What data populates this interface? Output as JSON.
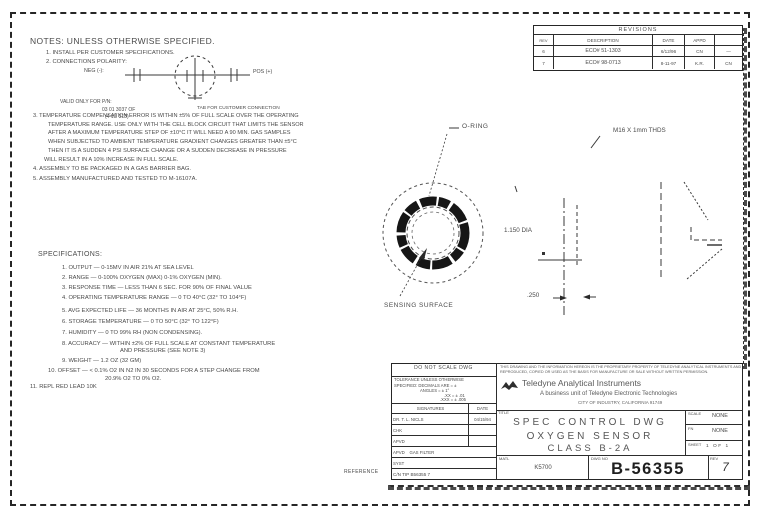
{
  "notes": {
    "heading": "NOTES: UNLESS OTHERWISE SPECIFIED.",
    "note1": "1. INSTALL PER CUSTOMER SPECIFICATIONS.",
    "note2": "2. CONNECTIONS POLARITY:",
    "polarity_neg": "NEG (-):",
    "polarity_pos": "POS (+)",
    "polarity_tab": "TAB FOR CUSTOMER CONNECTION",
    "valid1": "VALID ONLY FOR P/N:",
    "valid2": "03 01 3037 OF",
    "valid3": "(4 1U 313)",
    "note3_l1": "3. TEMPERATURE COMPENSATION ERROR IS WITHIN ±5% OF FULL SCALE OVER THE OPERATING",
    "note3_l2": "TEMPERATURE RANGE. USE ONLY WITH THE CELL BLOCK CIRCUIT THAT LIMITS THE SENSOR",
    "note3_l3": "AFTER A MAXIMUM TEMPERATURE STEP OF ±10°C IT WILL NEED A 90 MIN. GAS SAMPLES",
    "note3_l4": "WHEN SUBJECTED TO AMBIENT TEMPERATURE GRADIENT CHANGES GREATER THAN ±5°C",
    "note3_l5": "THEN IT IS A SUDDEN 4 PSI SURFACE CHANGE OR A SUDDEN DECREASE IN PRESSURE",
    "note3_l6": "WILL RESULT IN A 10% INCREASE IN FULL SCALE.",
    "note4": "4. ASSEMBLY TO BE PACKAGED IN A GAS BARRIER BAG.",
    "note5": "5. ASSEMBLY MANUFACTURED AND TESTED TO M-16107A."
  },
  "specs": {
    "heading": "SPECIFICATIONS:",
    "s1": "1. OUTPUT — 0-15MV IN AIR 21% AT SEA LEVEL",
    "s2": "2. RANGE — 0-100% OXYGEN (MAX) 0-1% OXYGEN (MIN).",
    "s3": "3. RESPONSE TIME — LESS THAN 6 SEC. FOR 90% OF FINAL VALUE",
    "s4": "4. OPERATING TEMPERATURE RANGE — 0 TO 40°C (32° TO 104°F)",
    "s5": "5. AVG EXPECTED LIFE — 36 MONTHS IN AIR AT 25°C, 50% R.H.",
    "s6": "6. STORAGE TEMPERATURE — 0 TO 50°C (32° TO 122°F)",
    "s7": "7. HUMIDITY — 0 TO 99% RH (NON CONDENSING).",
    "s8a": "8. ACCURACY — WITHIN ±2% OF FULL SCALE AT CONSTANT TEMPERATURE",
    "s8b": "AND PRESSURE (SEE NOTE 3)",
    "s9": "9. WEIGHT — 1.2 OZ (32 GM)",
    "s10a": "10. OFFSET — < 0.1% O2 IN N2 IN 30 SECONDS FOR A STEP CHANGE FROM",
    "s10b": "20.9% O2 TO 0% O2.",
    "s11": "11. REPL RED LEAD 10K"
  },
  "views": {
    "oring": "O-RING",
    "sensing": "SENSING SURFACE",
    "dia": "1.150 DIA",
    "thk": ".250",
    "thread": "M16 X 1mm THDS"
  },
  "revisions": {
    "title": "REVISIONS",
    "h_rev": "REV",
    "h_desc": "DESCRIPTION",
    "h_date": "DATE",
    "h_appd": "APPD",
    "h_chk": "",
    "rows": [
      {
        "rev": "6",
        "desc": "ECO# 51-1303",
        "date": "6/12/96",
        "appd": "CN",
        "chk": "—"
      },
      {
        "rev": "7",
        "desc": "ECO# 98-0713",
        "date": "8-11-97",
        "appd": "K.R.",
        "chk": "CN"
      }
    ]
  },
  "title_block": {
    "do_not_scale": "DO NOT SCALE DWG",
    "tol1": "TOLERANCE UNLESS OTHERWISE",
    "tol2": "SPECIFIED: DECIMALS ARE = ±",
    "tol3": "ANGLES = ± 1°",
    "tol4": ".XX = ± .01",
    "tol5": ".XXX = ± .005",
    "sig_h1": "SIGNATURES",
    "sig_h2": "DATE",
    "sig_r1_name": "DR. T. L. NICLS",
    "sig_r1_date": "04/15/94",
    "sig_r2_name": "CHK",
    "sig_r3_name": "APVD",
    "sig_r4_name": "APVD    GAS FILTER",
    "sig_r5_name": "SYST",
    "sig_r6_name": "C/N TIP B56355 7",
    "proprietary1": "THIS DRAWING AND THE INFORMATION HEREON IS THE PROPRIETARY PROPERTY OF TELEDYNE ANALYTICAL INSTRUMENTS AND MAY NOT BE",
    "proprietary2": "REPRODUCED, COPIED OR USED AS THE BASIS FOR MANUFACTURE OR SALE WITHOUT WRITTEN PERMISSION.",
    "company": "Teledyne Analytical Instruments",
    "company_sub": "A business unit of Teledyne Electronic Technologies",
    "company_addr": "CITY OF INDUSTRY, CALIFORNIA 91749",
    "title_label": "TITLE",
    "title_l1": "SPEC CONTROL DWG",
    "title_l2": "OXYGEN SENSOR",
    "title_l3": "CLASS B-2A",
    "matl_label": "MATL",
    "matl_value": "K5700",
    "dwgno_label": "DWG NO",
    "dwgno_value": "B-56355",
    "rev_label": "REV",
    "rev_value": "7",
    "scale_label": "SCALE",
    "scale_value": "NONE",
    "fn_label": "FN",
    "fn_value": "NONE",
    "sheet_label": "SHEET",
    "sheet_value": "1 OF 1",
    "reference": "REFERENCE"
  }
}
